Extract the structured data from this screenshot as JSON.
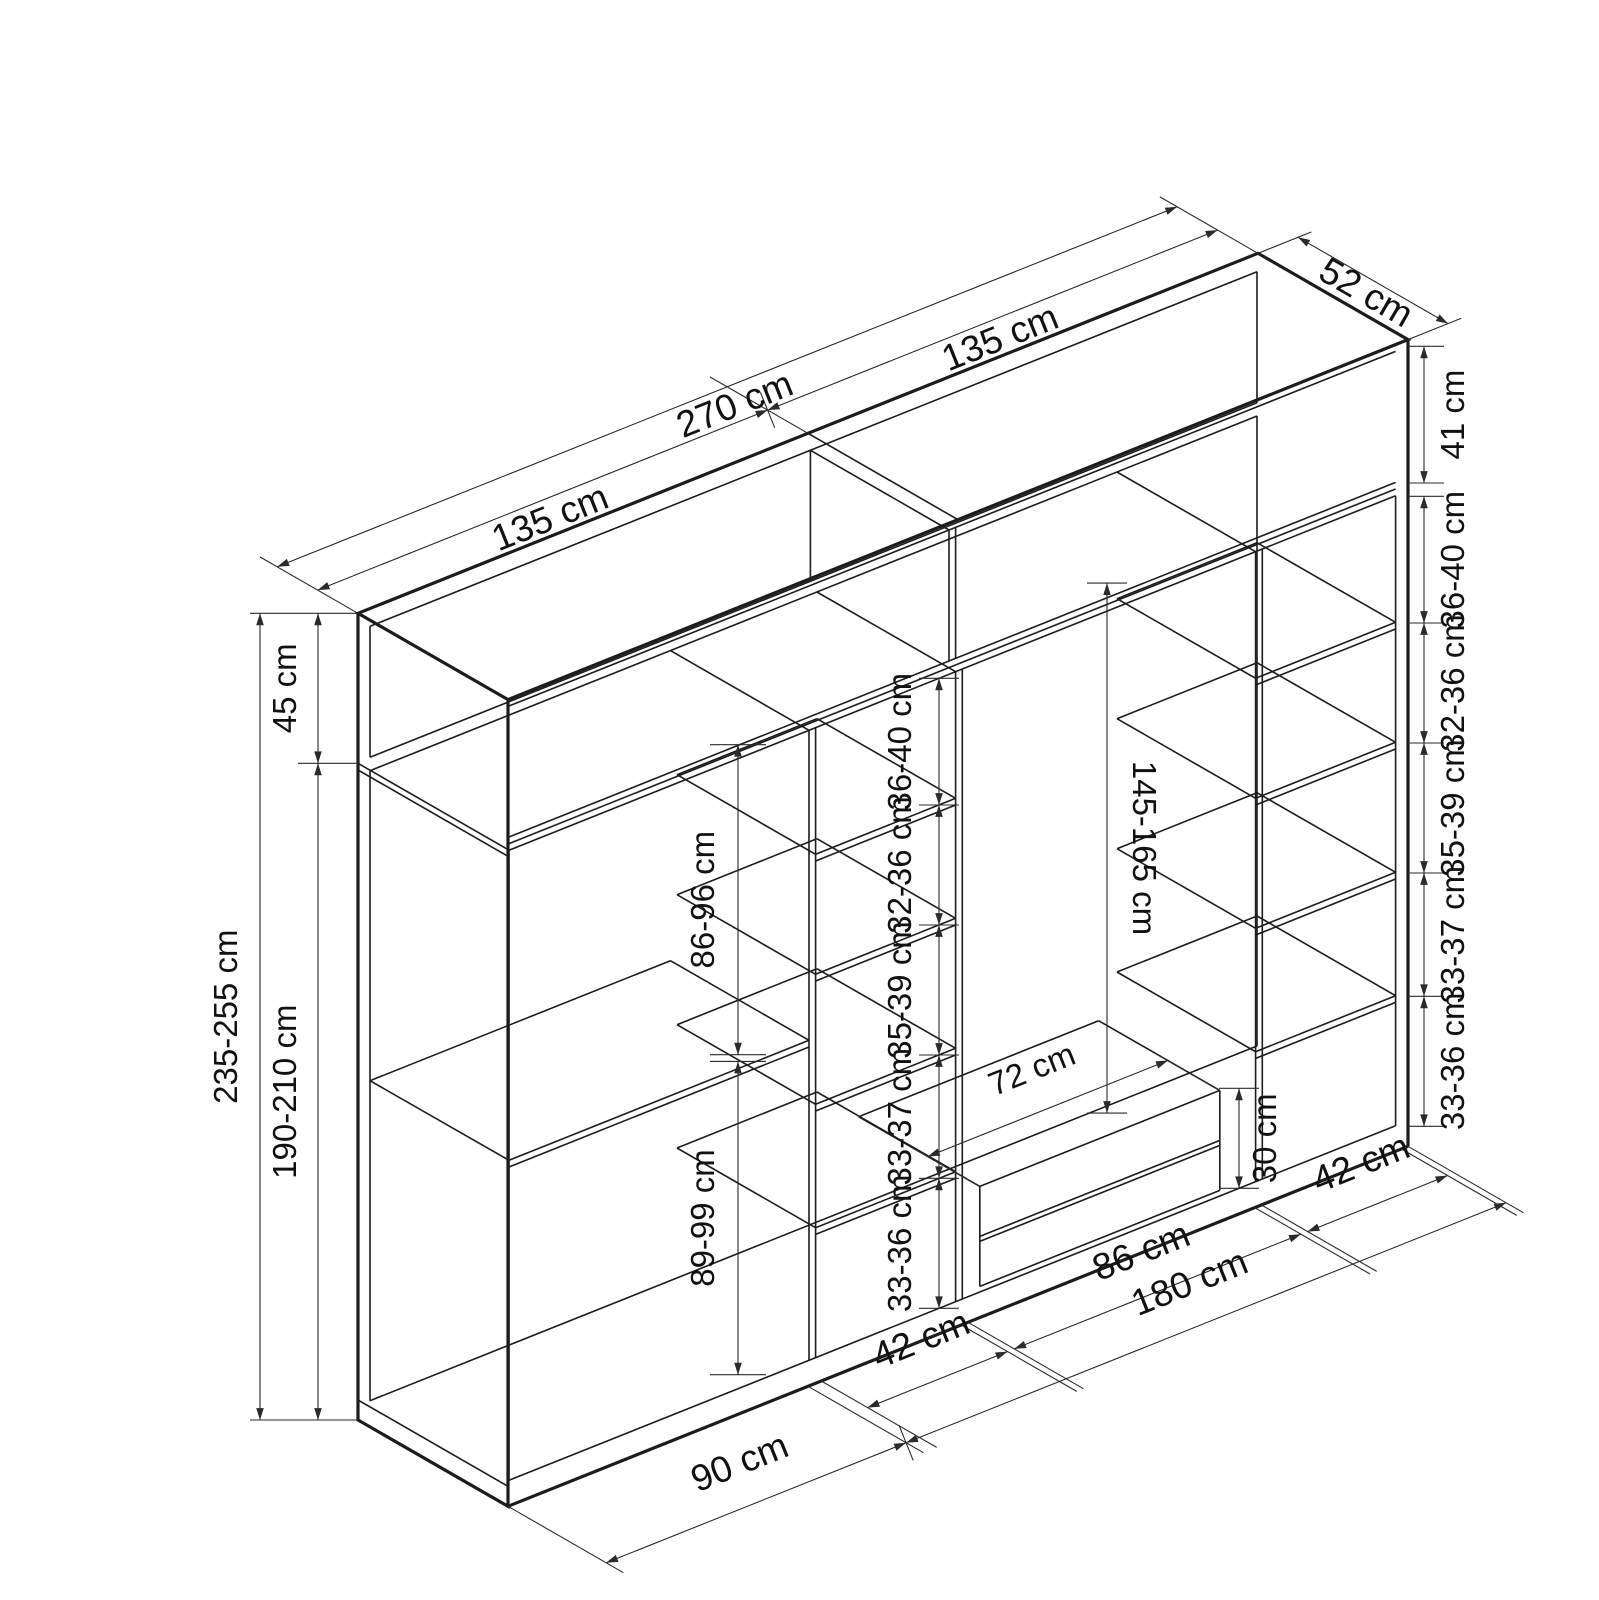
{
  "drawing": {
    "type": "wardrobe-technical-drawing",
    "background": "#ffffff",
    "line_color": "#1c1c1c",
    "dimension_color": "#2b2b2b",
    "text_color": "#111111",
    "units": "cm"
  },
  "dims": {
    "top": {
      "total_width": "270 cm",
      "left_half_width": "135 cm",
      "right_half_width": "135 cm",
      "depth": "52 cm"
    },
    "left_side": {
      "top_box_height": "45 cm",
      "total_height": "235-255 cm",
      "body_height": "190-210 cm",
      "upper_compartment": "86-96 cm",
      "lower_compartment": "89-99 cm"
    },
    "middle_shelves": [
      "36-40 cm",
      "32-36 cm",
      "35-39 cm",
      "33-37 cm",
      "33-36 cm"
    ],
    "right_shelves": [
      "41 cm",
      "36-40 cm",
      "32-36 cm",
      "35-39 cm",
      "33-37 cm",
      "33-36 cm"
    ],
    "center": {
      "hanging_height": "145-165 cm",
      "drawer_width": "72 cm",
      "drawer_unit_height": "30 cm"
    },
    "bottom": {
      "left_section_width": "90 cm",
      "shelf_column_width": "42 cm",
      "center_section_width": "86 cm",
      "right_span_width": "180 cm",
      "right_column_width": "42 cm"
    }
  }
}
